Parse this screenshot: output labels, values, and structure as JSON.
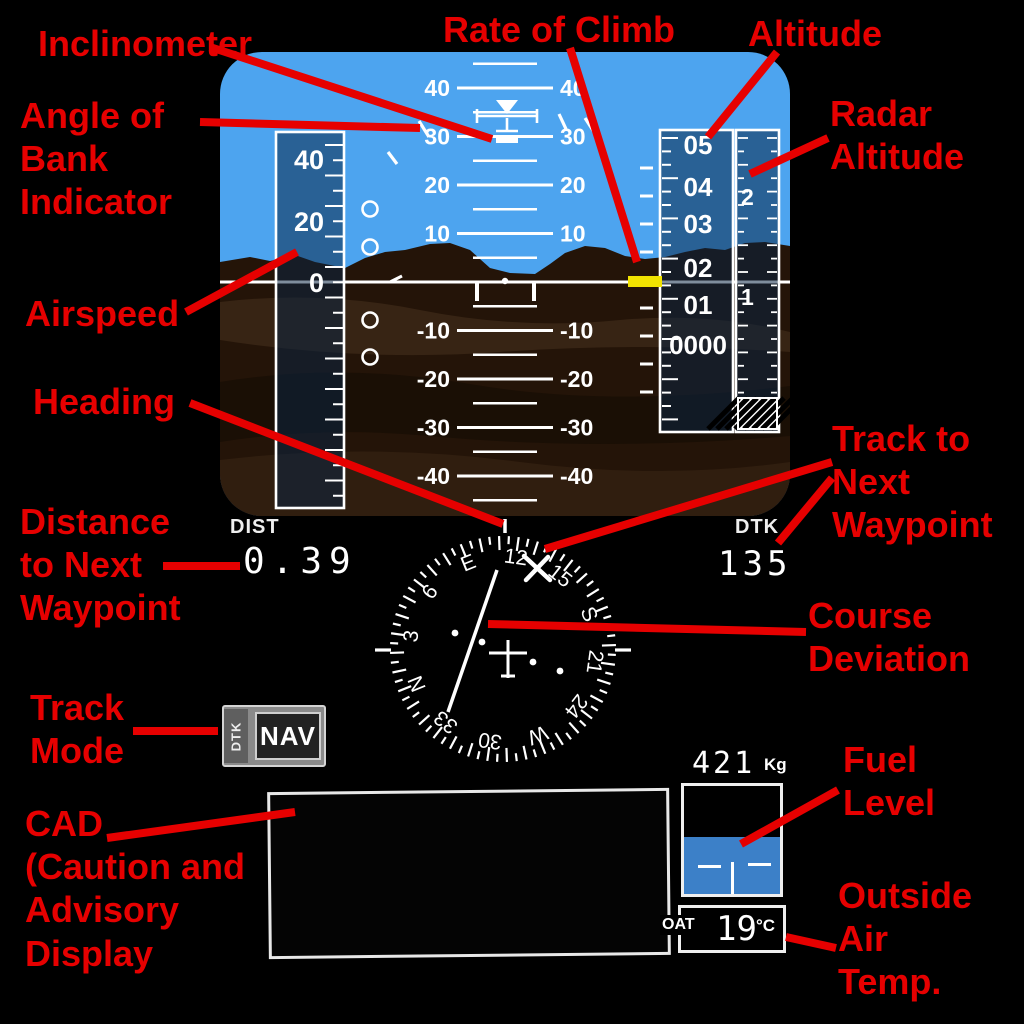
{
  "annotations": {
    "accent_color": "#e60000",
    "labels": {
      "inclinometer": "Inclinometer",
      "angle_of_bank": "Angle of\nBank\nIndicator",
      "airspeed": "Airspeed",
      "heading": "Heading",
      "distance_to_next_waypoint": "Distance\nto Next\nWaypoint",
      "track_mode": "Track\nMode",
      "cad": "CAD\n(Caution and\nAdvisory\nDisplay",
      "rate_of_climb": "Rate of Climb",
      "altitude": "Altitude",
      "radar_altitude": "Radar\nAltitude",
      "track_to_next_waypoint": "Track to\nNext\nWaypoint",
      "course_deviation": "Course\nDeviation",
      "fuel_level": "Fuel\nLevel",
      "outside_air_temp": "Outside\nAir\nTemp."
    }
  },
  "pfd": {
    "sky_color": "#4da4ef",
    "terrain_color": "#2b1b0e",
    "tape_fill": "rgba(10,36,68,0.52)",
    "roc_bar_color": "#f2e300",
    "pitch_major_degrees": [
      40,
      30,
      20,
      10,
      -10,
      -20,
      -30,
      -40
    ],
    "pitch_minor_degrees": [
      45,
      35,
      25,
      15,
      5,
      -5,
      -15,
      -25,
      -35,
      -45
    ],
    "airspeed_tape": {
      "values": [
        "40",
        "20",
        "0"
      ],
      "y": [
        160,
        222,
        283
      ]
    },
    "altitude_tape": {
      "values": [
        "05",
        "04",
        "03",
        "02",
        "01",
        "0000"
      ],
      "y": [
        145,
        187,
        224,
        268,
        305,
        345
      ]
    },
    "radar_altitude": {
      "values": [
        "2",
        "1"
      ],
      "y": [
        197,
        297
      ]
    }
  },
  "nav": {
    "dist": {
      "label": "DIST",
      "value": "0.39"
    },
    "dtk": {
      "label": "DTK",
      "value": "135"
    },
    "track_mode": {
      "prefix": "DTK",
      "mode": "NAV"
    },
    "hsi": {
      "heading_up": 112,
      "course": 135,
      "rose": [
        "N",
        "3",
        "6",
        "E",
        "12",
        "15",
        "S",
        "21",
        "24",
        "W",
        "30",
        "33"
      ]
    },
    "fuel": {
      "value": "421",
      "unit": "Kg"
    },
    "oat": {
      "label": "OAT",
      "value": "19",
      "unit": "°C"
    }
  }
}
